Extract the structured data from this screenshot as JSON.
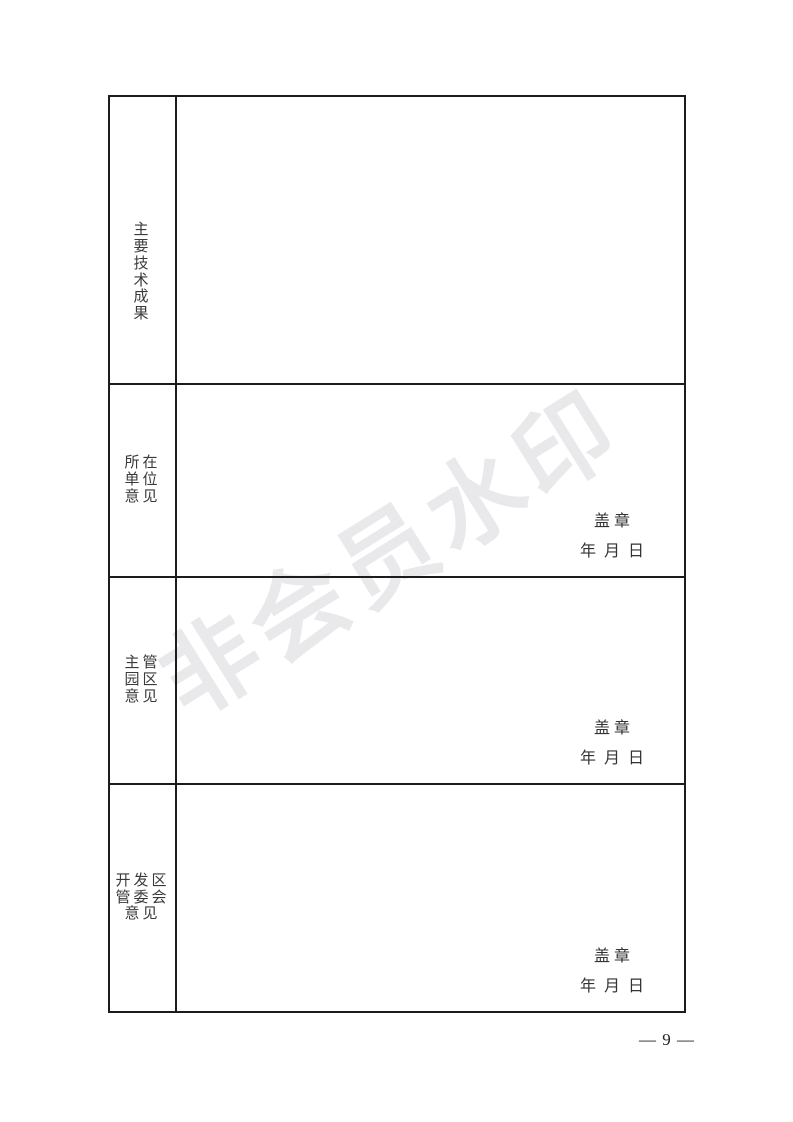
{
  "page": {
    "watermark": "非会员水印",
    "page_number": "— 9 —"
  },
  "table": {
    "rows": [
      {
        "id": "main-tech-achievements",
        "label": "主\n要\n技\n术\n成\n果"
      },
      {
        "id": "host-unit-opinion",
        "label": "所在\n单位\n意见",
        "signature": {
          "seal": "盖 章",
          "date": "年  月  日"
        }
      },
      {
        "id": "supervising-park-opinion",
        "label": "主管\n园区\n意见",
        "signature": {
          "seal": "盖 章",
          "date": "年  月  日"
        }
      },
      {
        "id": "devzone-committee-opinion",
        "label": "开发区\n管委会\n意见",
        "signature": {
          "seal": "盖 章",
          "date": "年  月  日"
        }
      }
    ]
  },
  "colors": {
    "border": "#1c1c1c",
    "text": "#3a3a3a",
    "watermark": "#e9e9ec"
  }
}
